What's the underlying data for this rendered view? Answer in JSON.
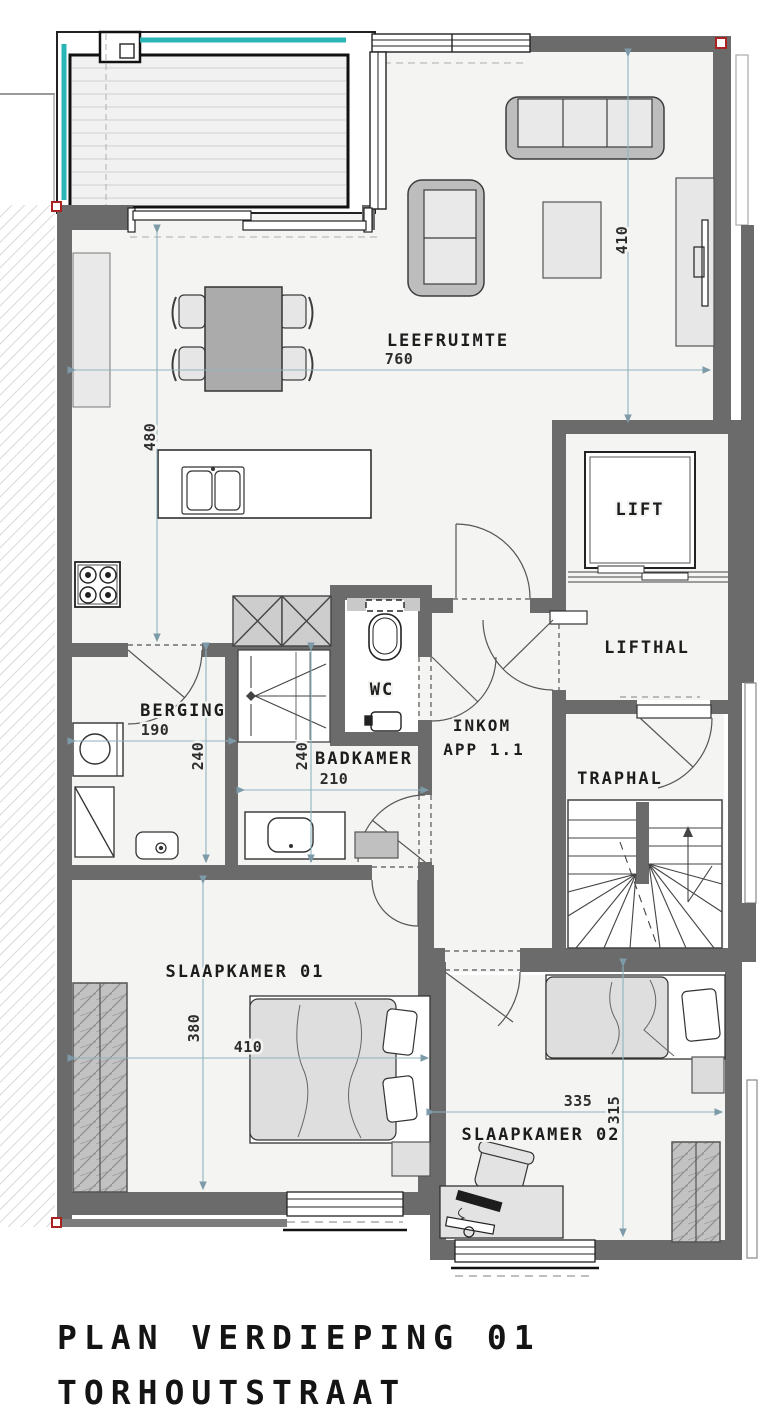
{
  "title": {
    "line1": "PLAN VERDIEPING 01",
    "line2": "TORHOUTSTRAAT"
  },
  "rooms": {
    "leefruimte": {
      "label": "LEEFRUIMTE"
    },
    "lift": {
      "label": "LIFT"
    },
    "lifthal": {
      "label": "LIFTHAL"
    },
    "traphal": {
      "label": "TRAPHAL"
    },
    "berging": {
      "label": "BERGING"
    },
    "wc": {
      "label": "WC"
    },
    "badkamer": {
      "label": "BADKAMER"
    },
    "inkom": {
      "label": "INKOM",
      "sublabel": "APP 1.1"
    },
    "slaapkamer01": {
      "label": "SLAAPKAMER 01"
    },
    "slaapkamer02": {
      "label": "SLAAPKAMER 02"
    }
  },
  "dimensions": {
    "leefruimte_width": "760",
    "leefruimte_depth": "410",
    "keuken_depth": "480",
    "berging_width": "190",
    "berging_depth": "240",
    "badkamer_depth": "240",
    "badkamer_width": "210",
    "slaapkamer01_depth": "380",
    "slaapkamer01_width": "410",
    "slaapkamer02_width": "335",
    "slaapkamer02_depth": "315"
  },
  "colors": {
    "wall": "#6b6b6b",
    "floor": "#f4f4f3",
    "terrace_accent": "#29b4b6",
    "dimension_line": "#8fb3bf",
    "corner_marker": "#aa2222"
  }
}
